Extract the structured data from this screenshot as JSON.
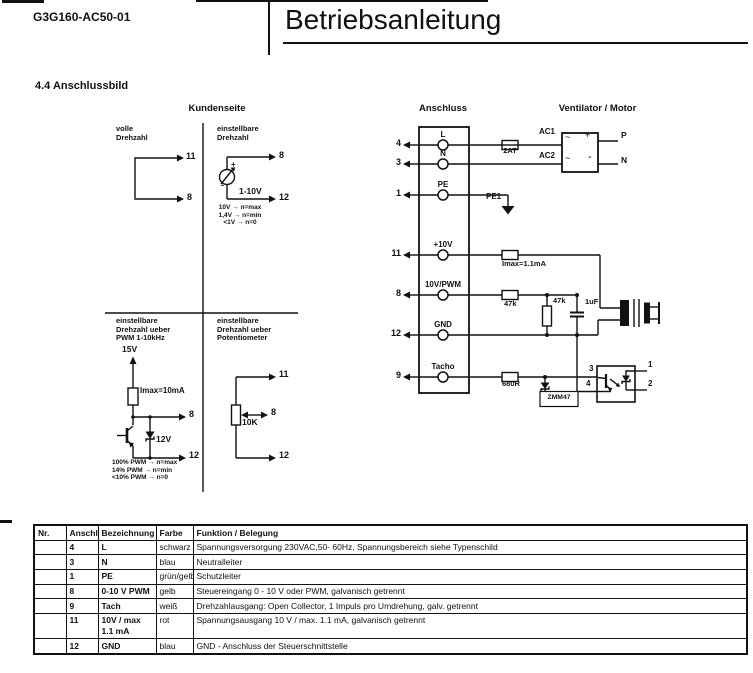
{
  "colors": {
    "ink": "#111111",
    "paper": "#ffffff"
  },
  "header": {
    "doc_number": "G3G160-AC50-01",
    "title": "Betriebsanleitung",
    "section": "4.4 Anschlussbild"
  },
  "left": {
    "title": "Kundenseite",
    "full_speed": {
      "label": "volle\nDrehzahl",
      "pin_top": "11",
      "pin_bottom": "8"
    },
    "adj_voltage": {
      "label": "einstellbare\nDrehzahl",
      "plus": "+",
      "minus": "-",
      "source": "1-10V",
      "pin_top": "8",
      "pin_bottom": "12",
      "notes": "10V → n=max\n1,4V → n=min\n<1V → n=0"
    },
    "adj_pwm": {
      "label": "einstellbare\nDrehzahl ueber\nPWM 1-10kHz",
      "supply": "15V",
      "resistor": "Imax=10mA",
      "zener": "12V",
      "pin_top": "8",
      "pin_bottom": "12",
      "notes": "100% PWM → n=max\n14% PWM → n=min\n<10% PWM → n=0"
    },
    "adj_pot": {
      "label": "einstellbare\nDrehzahl ueber\nPotentiometer",
      "pot": "10K",
      "pin_top": "11",
      "pin_mid": "8",
      "pin_bottom": "12"
    }
  },
  "right": {
    "title_block": "Anschluss",
    "title_motor": "Ventilator / Motor",
    "terminals": [
      {
        "num": "4",
        "name": "L"
      },
      {
        "num": "3",
        "name": "N"
      },
      {
        "num": "1",
        "name": "PE"
      },
      {
        "num": "11",
        "name": "+10V"
      },
      {
        "num": "8",
        "name": "10V/PWM"
      },
      {
        "num": "12",
        "name": "GND"
      },
      {
        "num": "9",
        "name": "Tacho"
      }
    ],
    "fuse": "2AT",
    "ac1": "AC1",
    "ac2": "AC2",
    "p": "P",
    "n": "N",
    "pe1": "PE1",
    "bridge": {
      "tl": "~",
      "tr": "+",
      "bl": "~",
      "br": "-"
    },
    "r10v": "Imax=1.1mA",
    "r_series": "47k",
    "r_shunt": "47k",
    "cap": "1uF",
    "r_tacho": "680R",
    "zener": "ZMM47",
    "opto": {
      "p3": "3",
      "p4": "4",
      "p1": "1",
      "p2": "2"
    }
  },
  "table": {
    "headers": [
      "Nr.",
      "Anschl.",
      "Bezeichnung",
      "Farbe",
      "Funktion / Belegung"
    ],
    "rows": [
      {
        "nr": "",
        "anschl": "4",
        "bezeichnung": "L",
        "farbe": "schwarz",
        "funktion": "Spannungsversorgung 230VAC,50- 60Hz, Spannungsbereich siehe Typenschild"
      },
      {
        "nr": "",
        "anschl": "3",
        "bezeichnung": "N",
        "farbe": "blau",
        "funktion": "Neutralleiter"
      },
      {
        "nr": "",
        "anschl": "1",
        "bezeichnung": "PE",
        "farbe": "grün/gelb",
        "funktion": "Schutzleiter"
      },
      {
        "nr": "",
        "anschl": "8",
        "bezeichnung": "0-10 V PWM",
        "farbe": "gelb",
        "funktion": "Steuereingang 0 - 10 V oder PWM, galvanisch getrennt"
      },
      {
        "nr": "",
        "anschl": "9",
        "bezeichnung": "Tach",
        "farbe": "weiß",
        "funktion": "Drehzahlausgang: Open Collector, 1 Impuls pro Umdrehung, galv. getrennt"
      },
      {
        "nr": "",
        "anschl": "11",
        "bezeichnung": "10V / max 1.1 mA",
        "farbe": "rot",
        "funktion": "Spannungsausgang 10 V / max. 1.1 mA, galvanisch getrennt"
      },
      {
        "nr": "",
        "anschl": "12",
        "bezeichnung": "GND",
        "farbe": "blau",
        "funktion": "GND - Anschluss der Steuerschnittstelle"
      }
    ]
  }
}
